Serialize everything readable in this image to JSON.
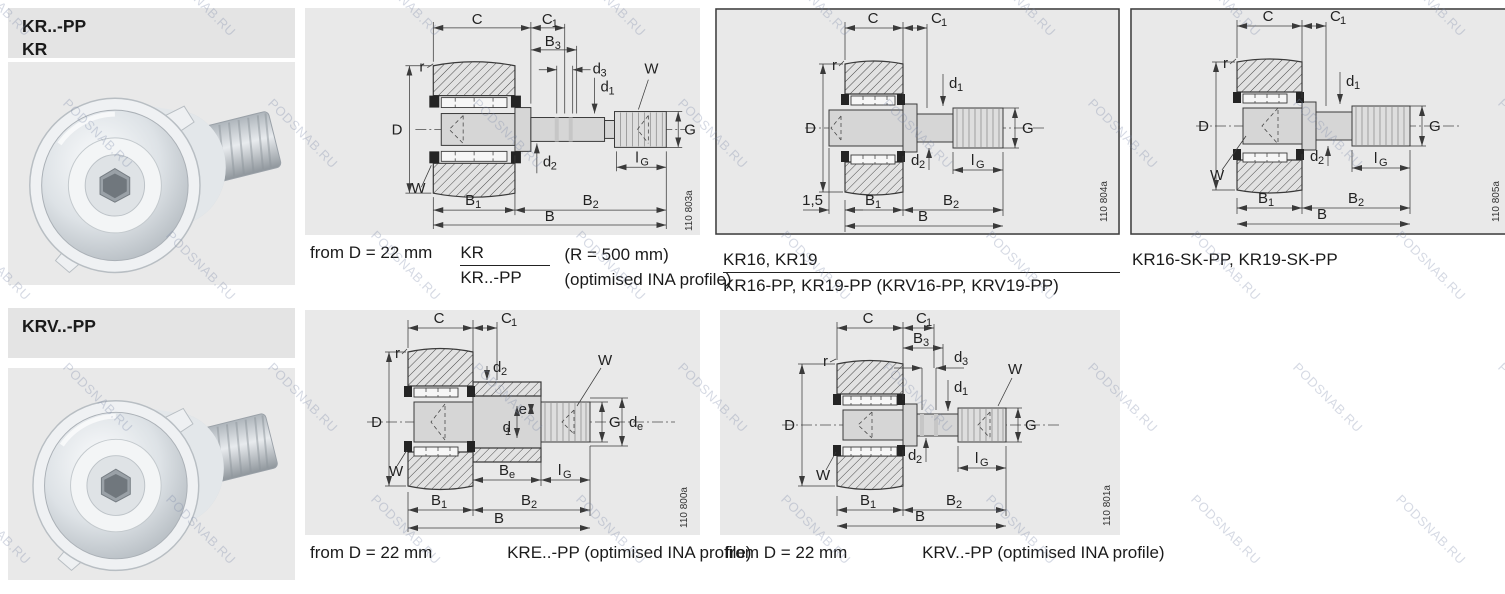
{
  "watermark": {
    "text": "PODSNAB.RU"
  },
  "colors": {
    "panel_bg": "#e9e9e9",
    "header_bg": "#e4e4e4",
    "drawing_line": "#3a3a3a"
  },
  "page": {
    "series_header_top": {
      "line1": "KR..-PP",
      "line2": "KR"
    },
    "series_header_bottom": {
      "line1": "KRV..-PP"
    }
  },
  "dim_labels": {
    "c": "C",
    "c1_base": "C",
    "c1_sub": "1",
    "b3_base": "B",
    "b3_sub": "3",
    "d3_base": "d",
    "d3_sub": "3",
    "d1_base": "d",
    "d1_sub": "1",
    "d2_base": "d",
    "d2_sub": "2",
    "b1_base": "B",
    "b1_sub": "1",
    "b2_base": "B",
    "b2_sub": "2",
    "b": "B",
    "d": "D",
    "g": "G",
    "r": "r",
    "w": "W",
    "lg_base": "l",
    "lg_sub": "G",
    "be_base": "B",
    "be_sub": "e",
    "de_base": "d",
    "de_sub": "e",
    "e": "e",
    "offset_15": "1,5"
  },
  "figures": {
    "kr": {
      "number": "110 803a",
      "caption_prefix": "from D = 22 mm",
      "caption_frac_top": "KR",
      "caption_frac_bottom": "KR..-PP",
      "caption_note_top": "(R = 500 mm)",
      "caption_note_bottom": "(optimised INA profile)"
    },
    "kr16": {
      "number": "110 804a",
      "caption_line1": "KR16, KR19",
      "caption_line2": "KR16-PP, KR19-PP (KRV16-PP, KRV19-PP)"
    },
    "kr16sk": {
      "number": "110 805a",
      "caption_line1": "KR16-SK-PP, KR19-SK-PP"
    },
    "kre": {
      "number": "110 800a",
      "caption_prefix": "from D = 22 mm",
      "caption_label": "KRE..-PP (optimised INA profile)"
    },
    "krv": {
      "number": "110 801a",
      "caption_prefix": "from D = 22 mm",
      "caption_label": "KRV..-PP (optimised INA profile)"
    }
  }
}
